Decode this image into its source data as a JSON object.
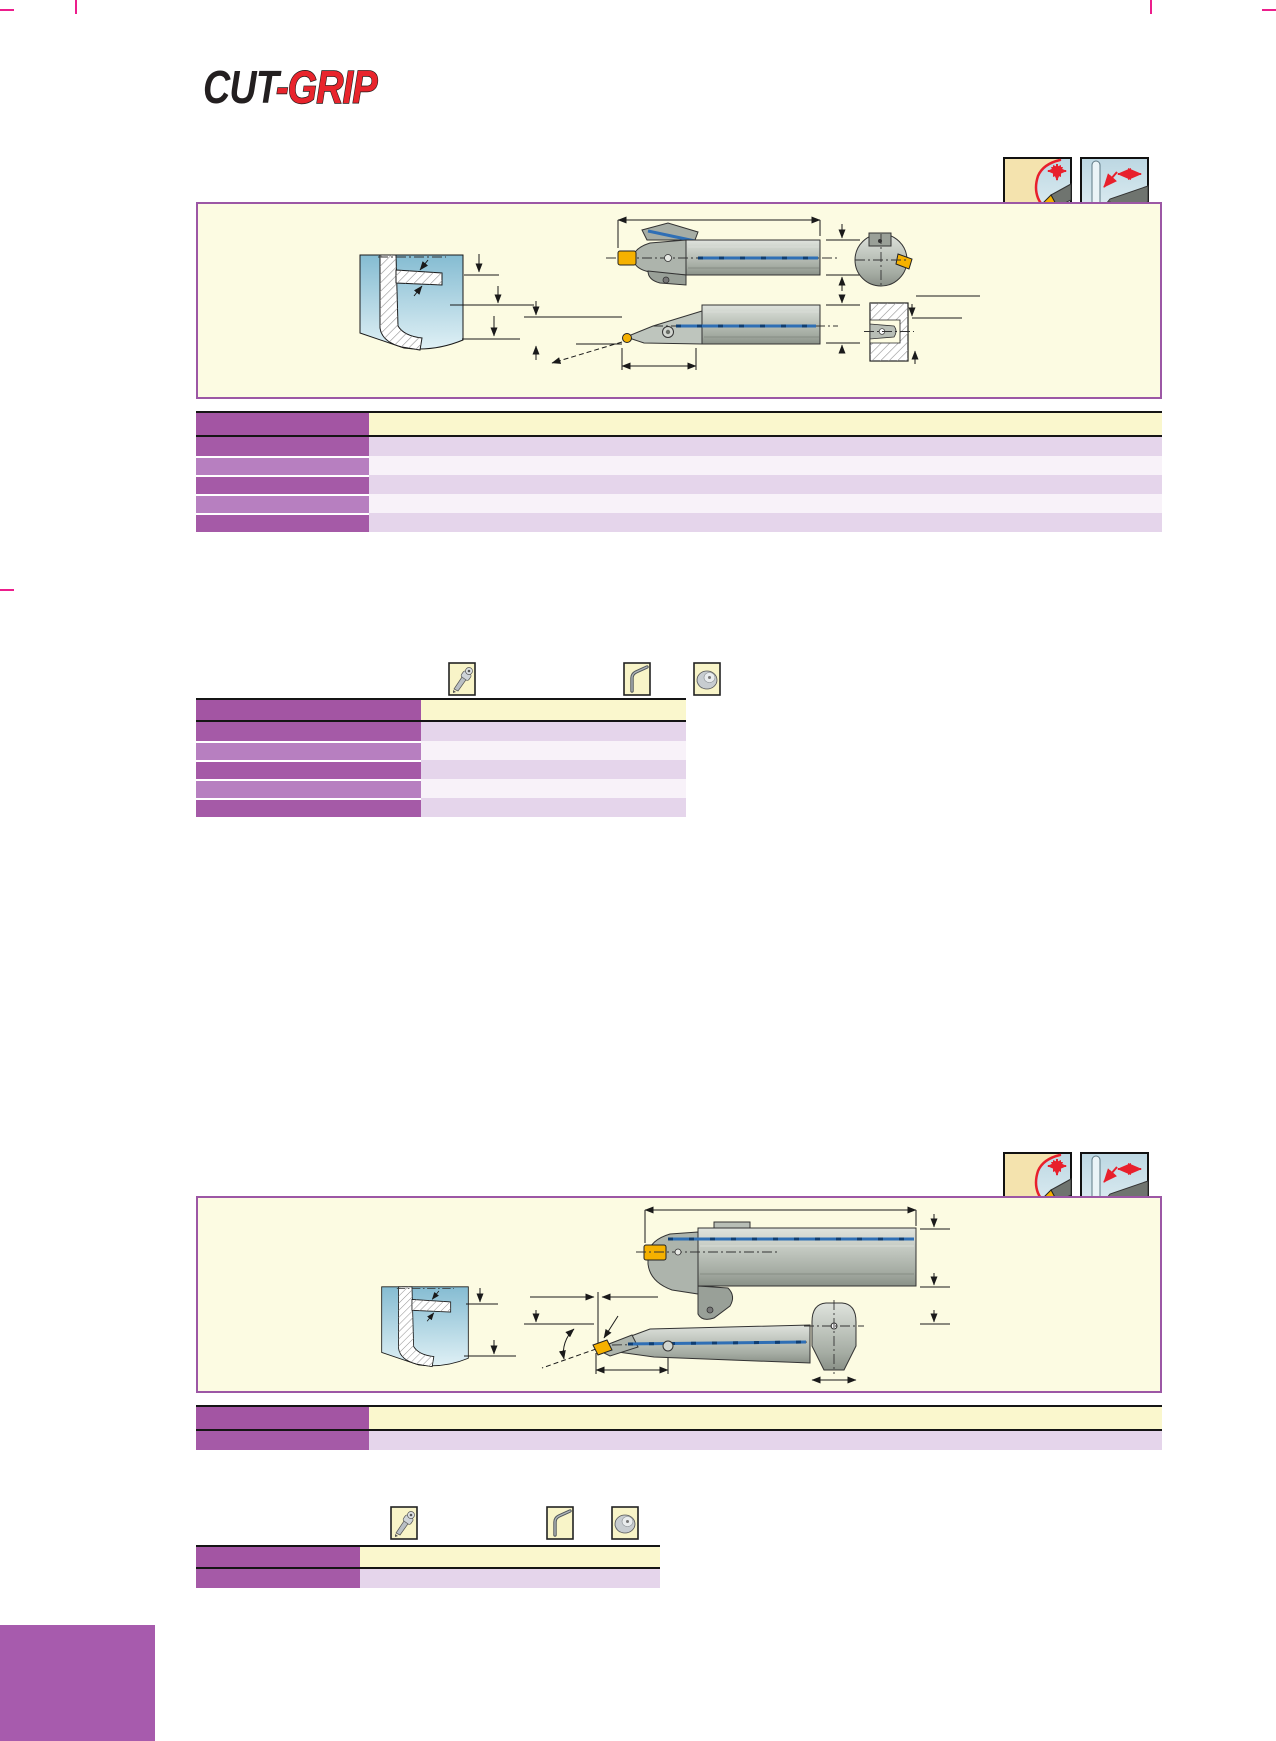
{
  "page": {
    "width": 1276,
    "height": 1741,
    "background": "#FFFFFF",
    "kind": "tool catalog page"
  },
  "brand": {
    "logo_cut": "CUT",
    "logo_grip": "-GRIP"
  },
  "colors": {
    "logo_black": "#231F20",
    "logo_red": "#E8242C",
    "panel_bg": "#FCFBE2",
    "panel_border": "#9C57A5",
    "table_border": "#151515",
    "table_header_left": "#A355A3",
    "table_header_right": "#FAF7CD",
    "row_dark_left": "#A55AA7",
    "row_dark_right": "#E5D5EB",
    "row_light_left": "#B77FC0",
    "row_light_right": "#F8F2F9",
    "crop_mark": "#EC1E8C",
    "corner_block": "#A75BAD",
    "icon_cream": "#F4E3AE",
    "icon_bg_cream": "#F8F4C8",
    "icon_red": "#E8202C",
    "coolant_blue": "#1B6FC0",
    "coolant_line": "#2F6FB5",
    "insert_yellow": "#F5B100",
    "tool_gray": "#B5BBB3",
    "workpiece_blue": "#8FC2D6"
  },
  "sections": [
    {
      "name": "section-top",
      "direction_icons": [
        {
          "name": "profile-machining-direction-icon",
          "x": 1003,
          "y": 157
        },
        {
          "name": "axial-grooving-direction-icon",
          "x": 1080,
          "y": 157
        }
      ],
      "coolant_icon": {
        "name": "coolant-icon",
        "x": 1080,
        "y": 235
      },
      "spare_part_icons": [
        {
          "name": "torx-driver-icon",
          "x": 448,
          "y": 662
        },
        {
          "name": "hex-key-icon",
          "x": 623,
          "y": 662
        },
        {
          "name": "clamp-screw-icon",
          "x": 693,
          "y": 662
        }
      ],
      "tables": [
        {
          "name": "tool-dimensions-table",
          "x": 196,
          "y": 411,
          "width": 966,
          "header_h": 22,
          "left_col_w": 173,
          "row_h": 19,
          "rows": [
            "dark",
            "light",
            "dark",
            "light",
            "dark"
          ]
        },
        {
          "name": "spare-parts-table",
          "x": 196,
          "y": 698,
          "width": 490,
          "header_h": 20,
          "left_col_w": 225,
          "row_h": 19,
          "rows": [
            "dark",
            "light",
            "dark",
            "light",
            "dark"
          ]
        }
      ]
    },
    {
      "name": "section-bottom",
      "direction_icons": [
        {
          "name": "profile-machining-direction-icon",
          "x": 1003,
          "y": 1152
        },
        {
          "name": "axial-grooving-direction-icon",
          "x": 1080,
          "y": 1152
        }
      ],
      "coolant_icon": {
        "name": "coolant-icon",
        "x": 1080,
        "y": 1230
      },
      "spare_part_icons": [
        {
          "name": "torx-driver-icon",
          "x": 390,
          "y": 1506
        },
        {
          "name": "hex-key-icon",
          "x": 546,
          "y": 1506
        },
        {
          "name": "clamp-screw-icon",
          "x": 611,
          "y": 1506
        }
      ],
      "tables": [
        {
          "name": "tool-dimensions-table",
          "x": 196,
          "y": 1405,
          "width": 966,
          "header_h": 22,
          "left_col_w": 173,
          "row_h": 19,
          "rows": [
            "dark"
          ]
        },
        {
          "name": "spare-parts-table",
          "x": 196,
          "y": 1545,
          "width": 464,
          "header_h": 20,
          "left_col_w": 164,
          "row_h": 19,
          "rows": [
            "dark"
          ]
        }
      ]
    }
  ]
}
